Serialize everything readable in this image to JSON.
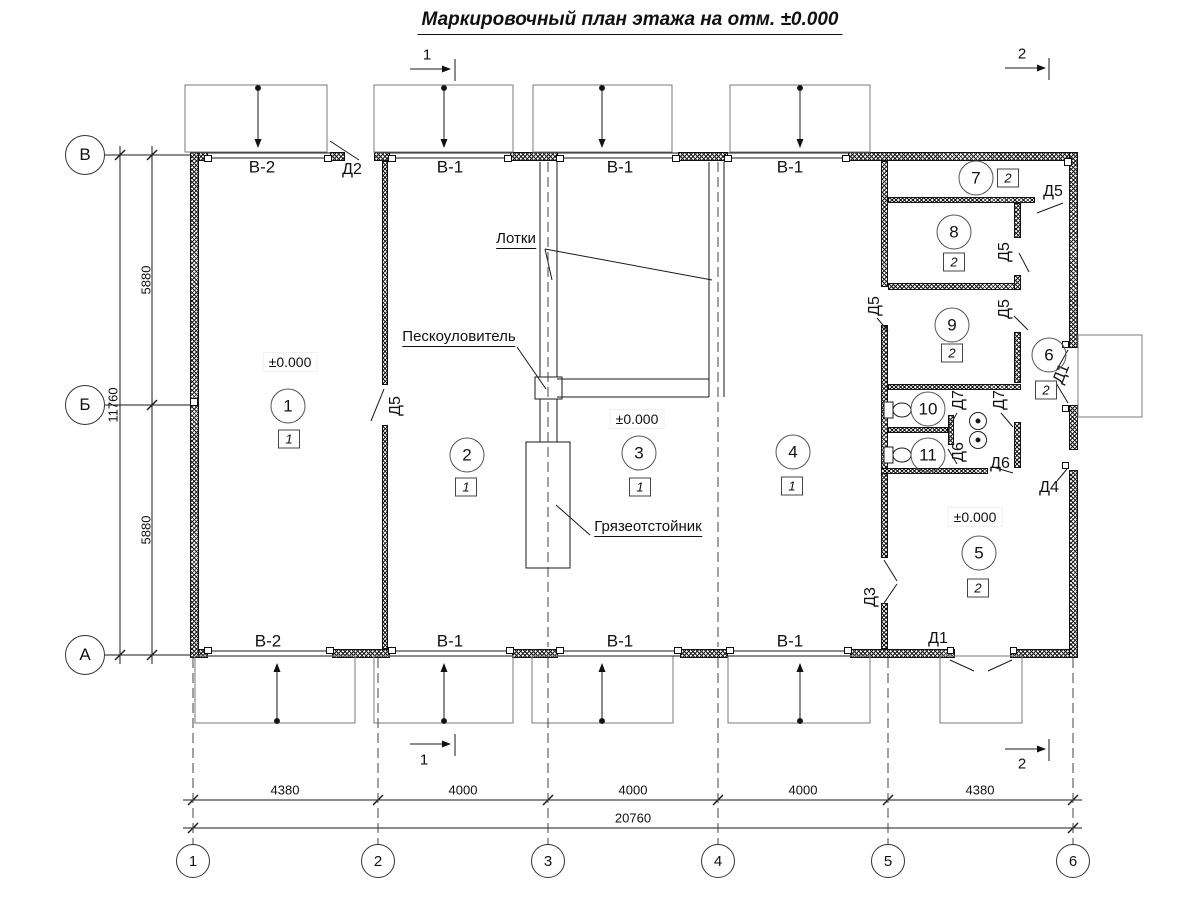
{
  "title": "Маркировочный план этажа на отм. ±0.000",
  "drawing": {
    "type": "floor-plan",
    "elevation": "±0.000",
    "total_length_mm": 20760,
    "total_width_mm": 11760,
    "bay_dimensions_mm": [
      4380,
      4000,
      4000,
      4000,
      4380
    ],
    "row_dimensions_mm": [
      5880,
      5880
    ]
  },
  "grid": {
    "bottom": [
      {
        "n": "grid-bubble-1",
        "t": "1",
        "x": 193
      },
      {
        "n": "grid-bubble-2",
        "t": "2",
        "x": 378
      },
      {
        "n": "grid-bubble-3",
        "t": "3",
        "x": 548
      },
      {
        "n": "grid-bubble-4",
        "t": "4",
        "x": 718
      },
      {
        "n": "grid-bubble-5",
        "t": "5",
        "x": 888
      },
      {
        "n": "grid-bubble-6",
        "t": "6",
        "x": 1073
      }
    ],
    "bottom_y": 861,
    "left": [
      {
        "n": "grid-bubble-v",
        "t": "В",
        "y": 155
      },
      {
        "n": "grid-bubble-b",
        "t": "Б",
        "y": 405
      },
      {
        "n": "grid-bubble-a",
        "t": "А",
        "y": 655
      }
    ],
    "left_x": 85
  },
  "rooms": [
    {
      "n": "room-1",
      "num": "1",
      "cx": 288,
      "cy": 406,
      "type": "1",
      "bx": 289,
      "by": 439
    },
    {
      "n": "room-2",
      "num": "2",
      "cx": 467,
      "cy": 455,
      "type": "1",
      "bx": 466,
      "by": 487
    },
    {
      "n": "room-3",
      "num": "3",
      "cx": 639,
      "cy": 453,
      "type": "1",
      "bx": 640,
      "by": 487
    },
    {
      "n": "room-4",
      "num": "4",
      "cx": 793,
      "cy": 452,
      "type": "1",
      "bx": 792,
      "by": 486
    },
    {
      "n": "room-5",
      "num": "5",
      "cx": 979,
      "cy": 553,
      "type": "2",
      "bx": 978,
      "by": 588
    },
    {
      "n": "room-6",
      "num": "6",
      "cx": 1049,
      "cy": 355,
      "type": "2",
      "bx": 1046,
      "by": 390
    },
    {
      "n": "room-7",
      "num": "7",
      "cx": 976,
      "cy": 178,
      "type": "2",
      "bx": 1008,
      "by": 178
    },
    {
      "n": "room-8",
      "num": "8",
      "cx": 954,
      "cy": 232,
      "type": "2",
      "bx": 954,
      "by": 262
    },
    {
      "n": "room-9",
      "num": "9",
      "cx": 952,
      "cy": 325,
      "type": "2",
      "bx": 952,
      "by": 353
    },
    {
      "n": "room-10",
      "num": "10",
      "cx": 928,
      "cy": 409
    },
    {
      "n": "room-11",
      "num": "11",
      "cx": 928,
      "cy": 455
    }
  ],
  "labels": [
    {
      "n": "gate-label",
      "t": "В-2",
      "x": 262,
      "y": 167,
      "f": 17
    },
    {
      "n": "gate-label",
      "t": "В-1",
      "x": 450,
      "y": 167,
      "f": 17
    },
    {
      "n": "gate-label",
      "t": "В-1",
      "x": 620,
      "y": 167,
      "f": 17
    },
    {
      "n": "gate-label",
      "t": "В-1",
      "x": 790,
      "y": 167,
      "f": 17
    },
    {
      "n": "gate-label",
      "t": "В-2",
      "x": 268,
      "y": 641,
      "f": 17
    },
    {
      "n": "gate-label",
      "t": "В-1",
      "x": 450,
      "y": 641,
      "f": 17
    },
    {
      "n": "gate-label",
      "t": "В-1",
      "x": 620,
      "y": 641,
      "f": 17
    },
    {
      "n": "gate-label",
      "t": "В-1",
      "x": 790,
      "y": 641,
      "f": 17
    },
    {
      "n": "door-label",
      "t": "Д2",
      "x": 352,
      "y": 170
    },
    {
      "n": "door-label",
      "t": "Д5",
      "x": 396,
      "y": 406,
      "r": -90
    },
    {
      "n": "door-label",
      "t": "Д5",
      "x": 1053,
      "y": 192
    },
    {
      "n": "door-label",
      "t": "Д5",
      "x": 1005,
      "y": 252,
      "r": -90
    },
    {
      "n": "door-label",
      "t": "Д5",
      "x": 875,
      "y": 306,
      "r": -90
    },
    {
      "n": "door-label",
      "t": "Д5",
      "x": 1005,
      "y": 309,
      "r": -90
    },
    {
      "n": "door-label",
      "t": "Д7",
      "x": 959,
      "y": 400,
      "r": -90
    },
    {
      "n": "door-label",
      "t": "Д7",
      "x": 1000,
      "y": 400,
      "r": -90
    },
    {
      "n": "door-label",
      "t": "Д6",
      "x": 959,
      "y": 452,
      "r": -90
    },
    {
      "n": "door-label",
      "t": "Д6",
      "x": 1000,
      "y": 464
    },
    {
      "n": "door-label",
      "t": "Д4",
      "x": 1049,
      "y": 488
    },
    {
      "n": "door-label",
      "t": "Д3",
      "x": 871,
      "y": 597,
      "r": -90
    },
    {
      "n": "door-label",
      "t": "Д1",
      "x": 1062,
      "y": 374,
      "r": -68
    },
    {
      "n": "door-label",
      "t": "Д1",
      "x": 938,
      "y": 639
    },
    {
      "n": "annotation-trays",
      "t": "Лотки",
      "x": 516,
      "y": 240,
      "f": 15,
      "u": 1
    },
    {
      "n": "annotation-sand-trap",
      "t": "Пескоуловитель",
      "x": 459,
      "y": 338,
      "f": 15,
      "u": 1
    },
    {
      "n": "annotation-mud-settler",
      "t": "Грязеотстойник",
      "x": 648,
      "y": 528,
      "f": 15,
      "u": 1
    },
    {
      "n": "elevation-mark",
      "t": "±0.000",
      "x": 290,
      "y": 362,
      "f": 14,
      "bg": 1
    },
    {
      "n": "elevation-mark",
      "t": "±0.000",
      "x": 637,
      "y": 419,
      "f": 14,
      "bg": 1
    },
    {
      "n": "elevation-mark",
      "t": "±0.000",
      "x": 975,
      "y": 517,
      "f": 14,
      "bg": 1
    },
    {
      "n": "dim-label",
      "t": "5880",
      "x": 146,
      "y": 280,
      "f": 13,
      "r": -90
    },
    {
      "n": "dim-label",
      "t": "11760",
      "x": 113,
      "y": 405,
      "f": 13,
      "r": -90
    },
    {
      "n": "dim-label",
      "t": "5880",
      "x": 146,
      "y": 530,
      "f": 13,
      "r": -90
    },
    {
      "n": "dim-label",
      "t": "4380",
      "x": 285,
      "y": 790,
      "f": 13
    },
    {
      "n": "dim-label",
      "t": "4000",
      "x": 463,
      "y": 790,
      "f": 13
    },
    {
      "n": "dim-label",
      "t": "4000",
      "x": 633,
      "y": 790,
      "f": 13
    },
    {
      "n": "dim-label",
      "t": "4000",
      "x": 803,
      "y": 790,
      "f": 13
    },
    {
      "n": "dim-label",
      "t": "4380",
      "x": 980,
      "y": 790,
      "f": 13
    },
    {
      "n": "dim-label",
      "t": "20760",
      "x": 633,
      "y": 818,
      "f": 13
    },
    {
      "n": "section-mark",
      "t": "1",
      "x": 427,
      "y": 55,
      "f": 15
    },
    {
      "n": "section-mark",
      "t": "2",
      "x": 1022,
      "y": 54,
      "f": 15
    },
    {
      "n": "section-mark",
      "t": "1",
      "x": 424,
      "y": 760,
      "f": 15
    },
    {
      "n": "section-mark",
      "t": "2",
      "x": 1022,
      "y": 764,
      "f": 15
    }
  ],
  "geo": {
    "walls": [
      [
        190,
        152,
        18,
        9
      ],
      [
        330,
        152,
        15,
        9
      ],
      [
        374,
        152,
        16,
        9
      ],
      [
        510,
        152,
        48,
        9
      ],
      [
        678,
        152,
        50,
        9
      ],
      [
        848,
        152,
        230,
        9
      ],
      [
        190,
        649,
        18,
        9
      ],
      [
        332,
        649,
        58,
        9
      ],
      [
        512,
        649,
        46,
        9
      ],
      [
        680,
        649,
        48,
        9
      ],
      [
        850,
        649,
        105,
        9
      ],
      [
        1010,
        649,
        68,
        9
      ],
      [
        190,
        152,
        9,
        506
      ],
      [
        1069,
        152,
        9,
        196
      ],
      [
        1069,
        405,
        9,
        45
      ],
      [
        1069,
        470,
        9,
        188
      ],
      [
        382,
        161,
        6,
        224
      ],
      [
        382,
        425,
        6,
        224
      ],
      [
        881,
        161,
        7,
        126
      ],
      [
        881,
        325,
        7,
        233
      ],
      [
        881,
        603,
        7,
        46
      ],
      [
        888,
        197,
        147,
        6
      ],
      [
        888,
        283,
        132,
        7
      ],
      [
        1014,
        203,
        7,
        35
      ],
      [
        1014,
        275,
        7,
        15
      ],
      [
        1014,
        332,
        7,
        51
      ],
      [
        1014,
        422,
        7,
        46
      ],
      [
        888,
        384,
        133,
        6
      ],
      [
        888,
        427,
        60,
        6
      ],
      [
        948,
        415,
        6,
        30
      ],
      [
        881,
        468,
        107,
        6
      ]
    ],
    "jambs": [
      [
        204,
        155,
        8,
        7
      ],
      [
        324,
        155,
        8,
        7
      ],
      [
        388,
        155,
        8,
        7
      ],
      [
        504,
        155,
        8,
        7
      ],
      [
        556,
        155,
        8,
        7
      ],
      [
        672,
        155,
        8,
        7
      ],
      [
        724,
        155,
        8,
        7
      ],
      [
        842,
        155,
        8,
        7
      ],
      [
        204,
        647,
        8,
        7
      ],
      [
        326,
        647,
        8,
        7
      ],
      [
        388,
        647,
        8,
        7
      ],
      [
        506,
        647,
        8,
        7
      ],
      [
        556,
        647,
        8,
        7
      ],
      [
        674,
        647,
        8,
        7
      ],
      [
        726,
        647,
        8,
        7
      ],
      [
        844,
        647,
        8,
        7
      ],
      [
        1064,
        158,
        8,
        8
      ],
      [
        947,
        647,
        7,
        7
      ],
      [
        1010,
        647,
        7,
        7
      ],
      [
        1062,
        341,
        7,
        7
      ],
      [
        1062,
        405,
        7,
        7
      ],
      [
        1062,
        462,
        7,
        7
      ],
      [
        190,
        398,
        8,
        8
      ]
    ],
    "gray_rects": [
      [
        185,
        85,
        142,
        67
      ],
      [
        374,
        85,
        139,
        67
      ],
      [
        533,
        85,
        139,
        67
      ],
      [
        730,
        85,
        140,
        67
      ],
      [
        195,
        656,
        160,
        67
      ],
      [
        374,
        656,
        139,
        67
      ],
      [
        532,
        656,
        141,
        67
      ],
      [
        728,
        656,
        142,
        67
      ],
      [
        940,
        656,
        82,
        67
      ],
      [
        1078,
        335,
        64,
        82
      ]
    ],
    "white_boxes": [
      [
        535,
        377,
        27,
        22
      ],
      [
        526,
        442,
        44,
        126
      ],
      [
        884,
        402,
        9,
        16
      ],
      [
        884,
        447,
        9,
        16
      ]
    ],
    "lines": [
      [
        105,
        155,
        190,
        155
      ],
      [
        105,
        405,
        190,
        405
      ],
      [
        105,
        655,
        190,
        655
      ],
      [
        152,
        146,
        152,
        664
      ],
      [
        120,
        146,
        120,
        664
      ],
      [
        183,
        800,
        1082,
        800
      ],
      [
        183,
        828,
        1082,
        828
      ],
      [
        455,
        59,
        455,
        81
      ],
      [
        1049,
        58,
        1049,
        80
      ],
      [
        455,
        734,
        455,
        756
      ],
      [
        1049,
        739,
        1049,
        761
      ],
      [
        208,
        153,
        330,
        153
      ],
      [
        208,
        158,
        330,
        158
      ],
      [
        390,
        153,
        510,
        153
      ],
      [
        390,
        158,
        510,
        158
      ],
      [
        558,
        153,
        678,
        153
      ],
      [
        558,
        158,
        678,
        158
      ],
      [
        728,
        153,
        848,
        153
      ],
      [
        728,
        158,
        848,
        158
      ],
      [
        208,
        651,
        332,
        651
      ],
      [
        208,
        656,
        332,
        656
      ],
      [
        390,
        651,
        512,
        651
      ],
      [
        390,
        656,
        512,
        656
      ],
      [
        558,
        651,
        680,
        651
      ],
      [
        558,
        656,
        680,
        656
      ],
      [
        728,
        651,
        850,
        651
      ],
      [
        728,
        656,
        850,
        656
      ],
      [
        540,
        162,
        540,
        377
      ],
      [
        557,
        162,
        557,
        377
      ],
      [
        540,
        399,
        540,
        442
      ],
      [
        557,
        399,
        557,
        442
      ],
      [
        709,
        162,
        709,
        397
      ],
      [
        724,
        162,
        724,
        397
      ],
      [
        557,
        379,
        709,
        379
      ],
      [
        557,
        397,
        709,
        397
      ],
      [
        545,
        249,
        552,
        280
      ],
      [
        545,
        249,
        712,
        280
      ],
      [
        517,
        347,
        546,
        389
      ],
      [
        590,
        535,
        556,
        505
      ],
      [
        330,
        141,
        359,
        160
      ],
      [
        384,
        389,
        371,
        421
      ],
      [
        1037,
        213,
        1063,
        203
      ],
      [
        1019,
        253,
        1029,
        272
      ],
      [
        1014,
        316,
        1028,
        330
      ],
      [
        877,
        318,
        888,
        331
      ],
      [
        884,
        560,
        897,
        581
      ],
      [
        897,
        584,
        884,
        603
      ],
      [
        1068,
        350,
        1056,
        371
      ],
      [
        1068,
        403,
        1056,
        383
      ],
      [
        1057,
        481,
        1067,
        469
      ],
      [
        950,
        660,
        974,
        671
      ],
      [
        1012,
        660,
        988,
        671
      ],
      [
        957,
        413,
        948,
        429
      ],
      [
        1001,
        413,
        1013,
        427
      ],
      [
        957,
        464,
        948,
        449
      ],
      [
        993,
        467,
        1013,
        473
      ],
      [
        147,
        160,
        157,
        150,
        "t"
      ],
      [
        147,
        410,
        157,
        400,
        "t"
      ],
      [
        147,
        660,
        157,
        650,
        "t"
      ],
      [
        115,
        160,
        125,
        150,
        "t"
      ],
      [
        115,
        660,
        125,
        650,
        "t"
      ],
      [
        188,
        805,
        198,
        795,
        "t"
      ],
      [
        373,
        805,
        383,
        795,
        "t"
      ],
      [
        543,
        805,
        553,
        795,
        "t"
      ],
      [
        713,
        805,
        723,
        795,
        "t"
      ],
      [
        883,
        805,
        893,
        795,
        "t"
      ],
      [
        1068,
        805,
        1078,
        795,
        "t"
      ],
      [
        188,
        833,
        198,
        823,
        "t"
      ],
      [
        1068,
        833,
        1078,
        823,
        "t"
      ],
      [
        193,
        658,
        193,
        845,
        "d"
      ],
      [
        378,
        658,
        378,
        845,
        "d"
      ],
      [
        548,
        658,
        548,
        845,
        "d"
      ],
      [
        718,
        658,
        718,
        845,
        "d"
      ],
      [
        888,
        658,
        888,
        845,
        "d"
      ],
      [
        1073,
        658,
        1073,
        845,
        "d"
      ],
      [
        548,
        162,
        548,
        647,
        "d"
      ],
      [
        718,
        162,
        718,
        647,
        "d"
      ],
      [
        258,
        90,
        258,
        147,
        "m"
      ],
      [
        444,
        90,
        444,
        147,
        "m"
      ],
      [
        602,
        90,
        602,
        147,
        "m"
      ],
      [
        800,
        90,
        800,
        147,
        "m"
      ],
      [
        277,
        719,
        277,
        664,
        "m"
      ],
      [
        444,
        719,
        444,
        664,
        "m"
      ],
      [
        602,
        719,
        602,
        664,
        "m"
      ],
      [
        800,
        719,
        800,
        664,
        "m"
      ],
      [
        410,
        69,
        450,
        69,
        "m"
      ],
      [
        1005,
        68,
        1045,
        68,
        "m"
      ],
      [
        410,
        744,
        450,
        744,
        "m"
      ],
      [
        1005,
        749,
        1045,
        749,
        "m"
      ]
    ],
    "circles": [
      [
        258,
        88,
        2.5,
        "f"
      ],
      [
        444,
        88,
        2.5,
        "f"
      ],
      [
        602,
        88,
        2.5,
        "f"
      ],
      [
        800,
        88,
        2.5,
        "f"
      ],
      [
        277,
        721,
        2.5,
        "f"
      ],
      [
        444,
        721,
        2.5,
        "f"
      ],
      [
        602,
        721,
        2.5,
        "f"
      ],
      [
        800,
        721,
        2.5,
        "f"
      ],
      [
        978,
        421,
        8.5,
        "s"
      ],
      [
        978,
        440,
        8.5,
        "s"
      ],
      [
        978,
        421,
        2,
        "f"
      ],
      [
        978,
        440,
        2,
        "f"
      ],
      [
        902,
        410,
        3.5,
        "s"
      ],
      [
        902,
        455,
        3.5,
        "s"
      ]
    ],
    "ellipses": [
      [
        902,
        410,
        9,
        7
      ],
      [
        902,
        455,
        9,
        7
      ]
    ]
  }
}
